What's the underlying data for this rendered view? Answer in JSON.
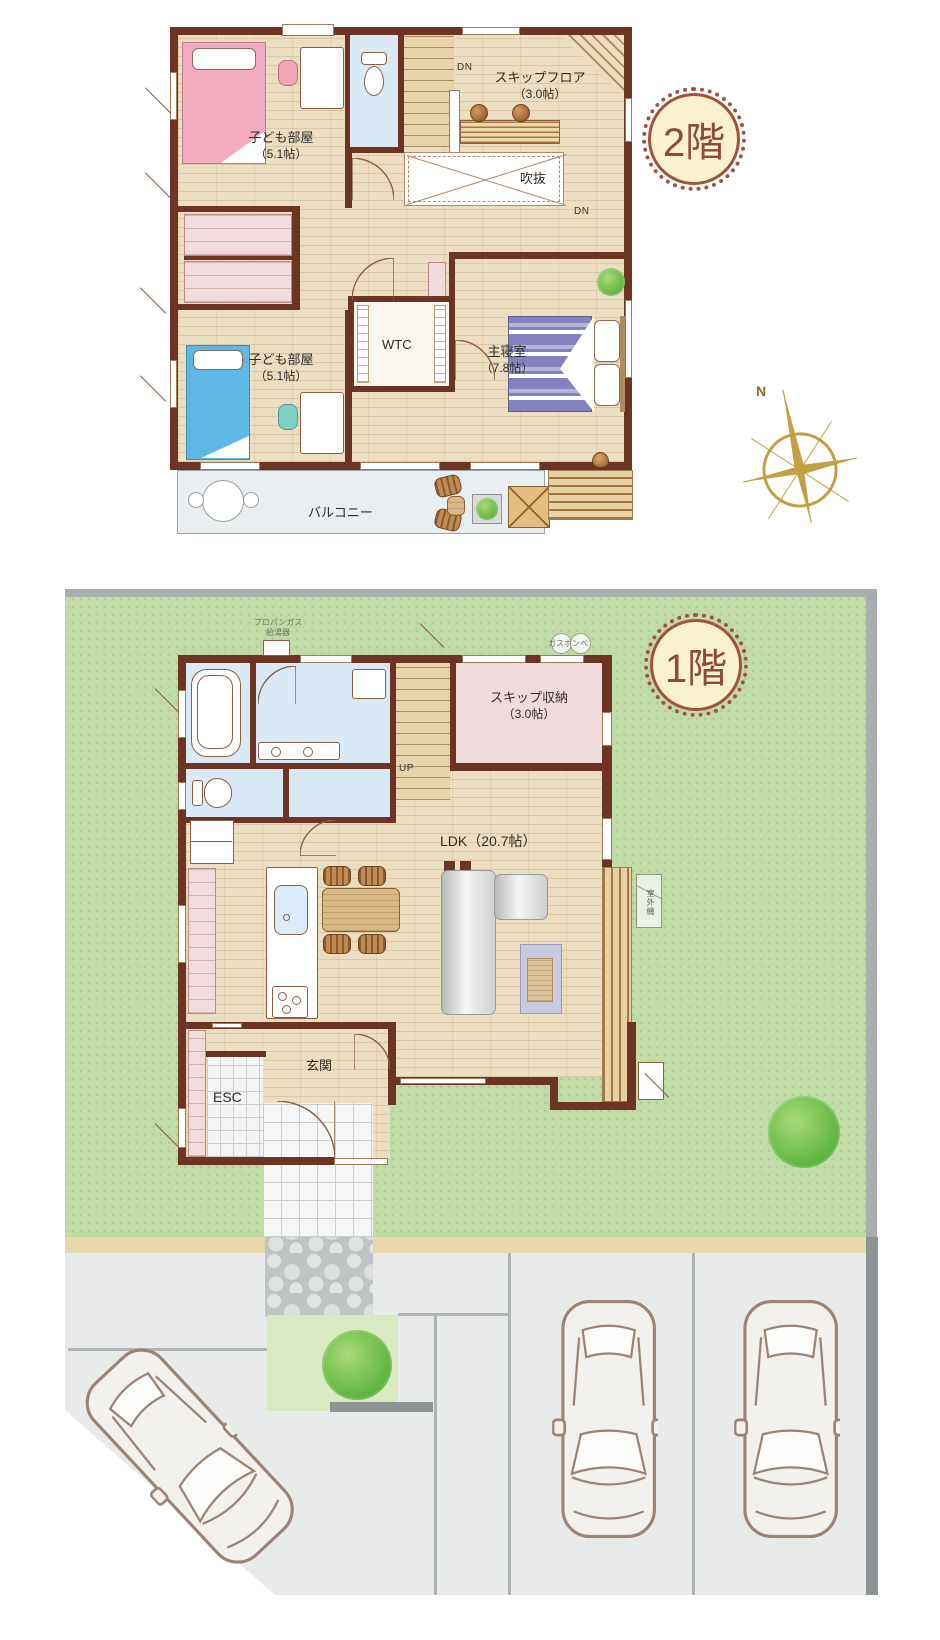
{
  "floor2": {
    "badge": "2階",
    "rooms": {
      "kids1": {
        "name": "子ども部屋",
        "size": "（5.1帖）"
      },
      "kids2": {
        "name": "子ども部屋",
        "size": "（5.1帖）"
      },
      "skip_floor": {
        "name": "スキップフロア",
        "size": "（3.0帖）"
      },
      "master": {
        "name": "主寝室",
        "size": "（7.8帖）"
      },
      "wtc": "WTC",
      "void": "吹抜",
      "balcony": "バルコニー"
    },
    "labels": {
      "dn_top": "DN",
      "dn_bottom": "DN",
      "compass_north": "N"
    }
  },
  "floor1": {
    "badge": "1階",
    "rooms": {
      "skip_storage": {
        "name": "スキップ収納",
        "size": "（3.0帖）"
      },
      "ldk": "LDK（20.7帖）",
      "entrance": "玄関",
      "esc": "ESC"
    },
    "labels": {
      "up": "UP",
      "water_heater_line1": "プロパンガス",
      "water_heater_line2": "給湯器",
      "gas_cylinder": "ガスボンベ",
      "outdoor_unit": "室外機"
    }
  },
  "colors": {
    "wall": "#6e3423",
    "wood_floor": "#ecdfc1",
    "wet_room": "#d9e9f6",
    "storage_pink": "#efdbdb",
    "lawn": "#c0dba6",
    "parking": "#e9ebeb",
    "balcony": "#e9eef1",
    "badge_bg": "#faf1cf",
    "badge_border": "#a1523e",
    "badge_text": "#8f4b38",
    "compass_gold": "#c2a144",
    "bed_pink": "#f3abc0",
    "bed_blue": "#5fb7e6",
    "bed_purple": "#8481be"
  }
}
